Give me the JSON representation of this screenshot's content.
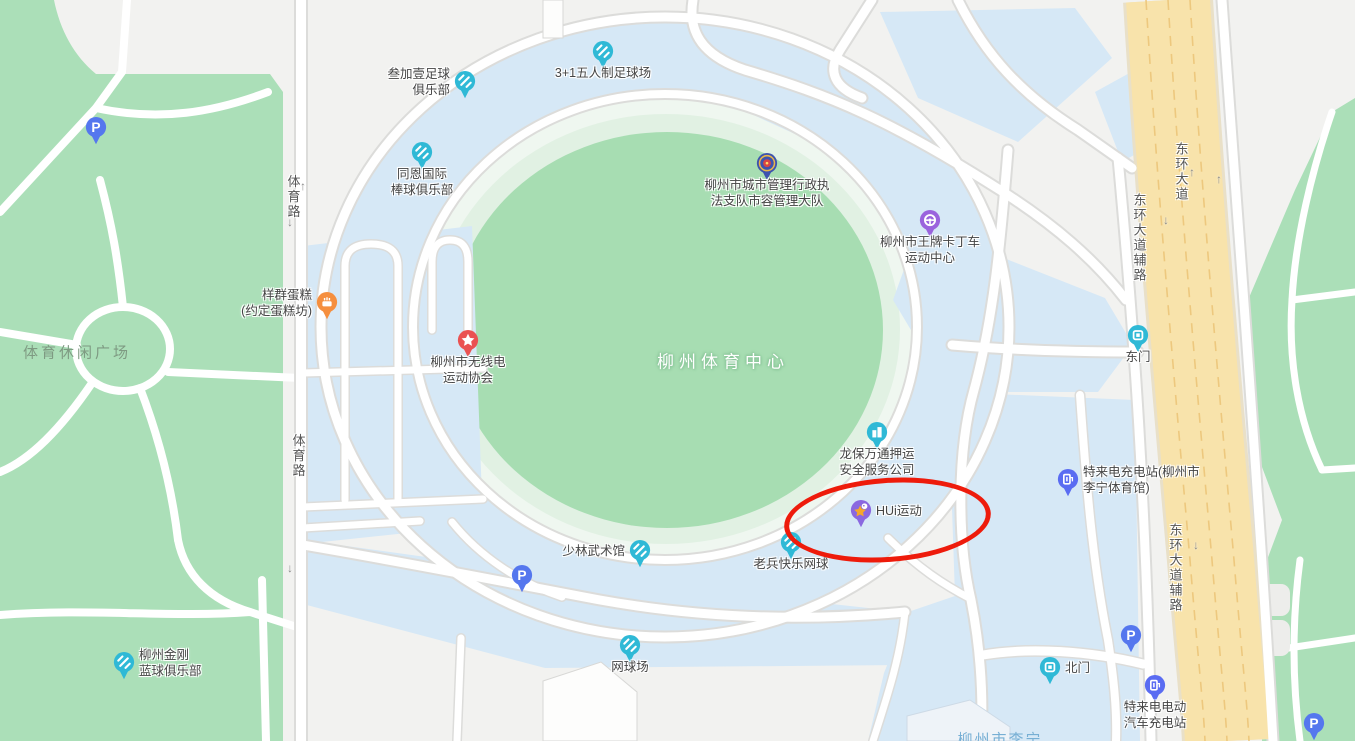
{
  "map": {
    "colors": {
      "background": "#f2f2f0",
      "park_green": "#abdfb8",
      "stadium_green": "#a7ddb2",
      "water_blue": "#d6e8f6",
      "road_white": "#ffffff",
      "road_casing": "#dcdcda",
      "avenue_yellow": "#f8e3ab",
      "teal_pin": "#2fb9d6",
      "purple_pin": "#9a63dd",
      "blue_pin": "#5577ee",
      "orange_pin": "#f58f3f",
      "red_pin": "#ea5252",
      "annotation_red": "#ee1b0b"
    },
    "area_labels": [
      {
        "name": "sports-leisure-plaza",
        "text": "体育休闲广场",
        "style": "al-park",
        "x": 77,
        "y": 352
      },
      {
        "name": "liuzhou-sports-center",
        "text": "柳州体育中心",
        "style": "al-stadium",
        "x": 723,
        "y": 360
      },
      {
        "name": "liuzhou-lining-stadium",
        "text": "柳州市李宁",
        "style": "al-water",
        "x": 1000,
        "y": 739
      }
    ],
    "road_labels": [
      {
        "name": "tiyu-road-north",
        "text": "体育路",
        "x": 293,
        "y": 197
      },
      {
        "name": "tiyu-road-south",
        "text": "体育路",
        "x": 298,
        "y": 456
      },
      {
        "name": "donghuan-avenue",
        "text": "东环大道",
        "x": 1181,
        "y": 172
      },
      {
        "name": "donghuan-frontage-north",
        "text": "东环大道辅路",
        "x": 1139,
        "y": 238
      },
      {
        "name": "donghuan-frontage-south",
        "text": "东环大道辅路",
        "x": 1175,
        "y": 568
      }
    ],
    "arrows": [
      {
        "glyph": "↑",
        "x": 303,
        "y": 186
      },
      {
        "glyph": "↓",
        "x": 290,
        "y": 222
      },
      {
        "glyph": "↑",
        "x": 304,
        "y": 448
      },
      {
        "glyph": "↓",
        "x": 290,
        "y": 568
      },
      {
        "glyph": "↑",
        "x": 1192,
        "y": 172
      },
      {
        "glyph": "↓",
        "x": 1166,
        "y": 220
      },
      {
        "glyph": "↑",
        "x": 1219,
        "y": 179
      },
      {
        "glyph": "↓",
        "x": 1196,
        "y": 545
      }
    ],
    "pois": [
      {
        "name": "sanjiayi-football-club",
        "icon": "sport",
        "color": "#2fb9d6",
        "x": 465,
        "y": 82,
        "label": [
          "叁加壹足球",
          "俱乐部"
        ],
        "pos": "left"
      },
      {
        "name": "3plus1-futsal-field",
        "icon": "sport",
        "color": "#2fb9d6",
        "x": 603,
        "y": 52,
        "label": [
          "3+1五人制足球场"
        ],
        "pos": "below"
      },
      {
        "name": "tongen-baseball-club",
        "icon": "sport",
        "color": "#2fb9d6",
        "x": 422,
        "y": 153,
        "label": [
          "同恩国际",
          "棒球俱乐部"
        ],
        "pos": "below"
      },
      {
        "name": "city-management-enforcement",
        "icon": "police",
        "color": "#3d53ae",
        "x": 767,
        "y": 164,
        "label": [
          "柳州市城市管理行政执",
          "法支队市容管理大队"
        ],
        "pos": "below"
      },
      {
        "name": "wangpai-karting-center",
        "icon": "kart",
        "color": "#9a63dd",
        "x": 930,
        "y": 221,
        "label": [
          "柳州市王牌卡丁车",
          "运动中心"
        ],
        "pos": "below"
      },
      {
        "name": "yangqun-cake-shop",
        "icon": "cake",
        "color": "#f58f3f",
        "x": 327,
        "y": 303,
        "label": [
          "样群蛋糕",
          "(约定蛋糕坊)"
        ],
        "pos": "left"
      },
      {
        "name": "radio-sports-association",
        "icon": "star",
        "color": "#ea5252",
        "x": 468,
        "y": 341,
        "label": [
          "柳州市无线电",
          "运动协会"
        ],
        "pos": "below"
      },
      {
        "name": "east-gate",
        "icon": "gate",
        "color": "#2fb9d6",
        "x": 1138,
        "y": 336,
        "label": [
          "东门"
        ],
        "pos": "below"
      },
      {
        "name": "longbao-escort-security",
        "icon": "building",
        "color": "#2fb9d6",
        "x": 877,
        "y": 433,
        "label": [
          "龙保万通押运",
          "安全服务公司"
        ],
        "pos": "below"
      },
      {
        "name": "hui-sports",
        "icon": "hui",
        "color": "#8a68e0",
        "x": 861,
        "y": 511,
        "label": [
          "HUi运动"
        ],
        "pos": "right"
      },
      {
        "name": "teld-charging-lining-gym",
        "icon": "charge",
        "color": "#5a6cf2",
        "x": 1068,
        "y": 480,
        "label": [
          "特来电充电站(柳州市",
          "李宁体育馆)"
        ],
        "pos": "right"
      },
      {
        "name": "shaolin-martial-arts-hall",
        "icon": "sport",
        "color": "#2fb9d6",
        "x": 640,
        "y": 551,
        "label": [
          "少林武术馆"
        ],
        "pos": "left"
      },
      {
        "name": "veteran-happy-tennis",
        "icon": "sport",
        "color": "#2fb9d6",
        "x": 791,
        "y": 543,
        "label": [
          "老兵快乐网球"
        ],
        "pos": "below"
      },
      {
        "name": "parking-northwest",
        "icon": "parking",
        "color": "#5577ee",
        "x": 96,
        "y": 128,
        "label": [],
        "pos": "below"
      },
      {
        "name": "parking-south",
        "icon": "parking",
        "color": "#5577ee",
        "x": 522,
        "y": 576,
        "label": [],
        "pos": "below"
      },
      {
        "name": "parking-east",
        "icon": "parking",
        "color": "#5577ee",
        "x": 1131,
        "y": 636,
        "label": [],
        "pos": "below"
      },
      {
        "name": "parking-southeast",
        "icon": "parking",
        "color": "#5577ee",
        "x": 1314,
        "y": 724,
        "label": [],
        "pos": "below"
      },
      {
        "name": "jingang-basketball-club",
        "icon": "sport",
        "color": "#2fb9d6",
        "x": 124,
        "y": 663,
        "label": [
          "柳州金刚",
          "蓝球俱乐部"
        ],
        "pos": "right"
      },
      {
        "name": "tennis-court",
        "icon": "sport",
        "color": "#2fb9d6",
        "x": 630,
        "y": 646,
        "label": [
          "网球场"
        ],
        "pos": "below"
      },
      {
        "name": "north-gate",
        "icon": "gate",
        "color": "#2fb9d6",
        "x": 1050,
        "y": 668,
        "label": [
          "北门"
        ],
        "pos": "right"
      },
      {
        "name": "teld-ev-charging-station",
        "icon": "charge",
        "color": "#5a6cf2",
        "x": 1155,
        "y": 686,
        "label": [
          "特来电电动",
          "汽车充电站"
        ],
        "pos": "below"
      }
    ],
    "annotation": {
      "shape": "ellipse",
      "color": "#ee1b0b",
      "target": "HUi运动"
    }
  }
}
